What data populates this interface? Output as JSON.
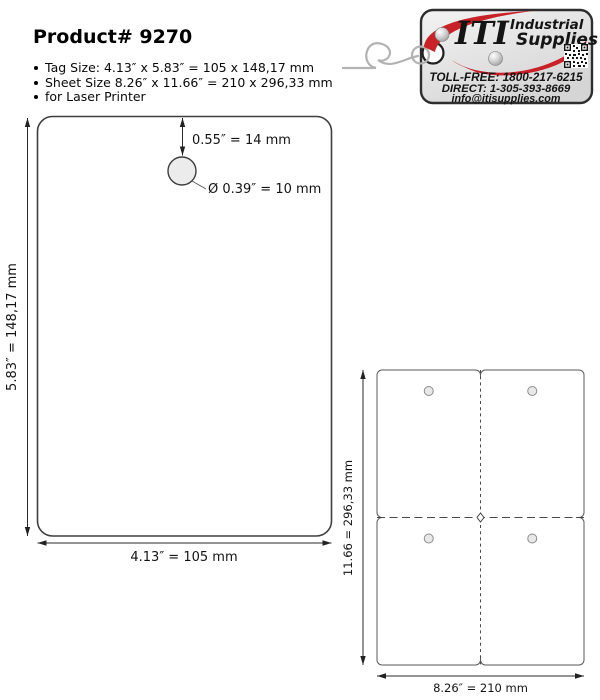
{
  "header": {
    "title": "Product# 9270"
  },
  "specs": [
    "Tag Size: 4.13″ x 5.83″ = 105 x 148,17 mm",
    "Sheet Size 8.26″ x 11.66″ = 210 x 296,33 mm",
    "for Laser Printer"
  ],
  "logo": {
    "brand": {
      "iti": "ITI",
      "industrial": "Industrial",
      "supplies": "Supplies"
    },
    "toll_free": "TOLL-FREE: 1800-217-6215",
    "direct": "DIRECT: 1-305-393-8669",
    "email": "info@itisupplies.com",
    "colors": {
      "blue": "#322b91",
      "red": "#c92128",
      "gray": "#9b9b9b",
      "tag_fill": "#e3e3e3"
    }
  },
  "tag_diagram": {
    "hole_offset": "0.55″ = 14 mm",
    "hole_diameter": "Ø 0.39″ = 10 mm",
    "height": "5.83″ = 148,17 mm",
    "width": "4.13″ = 105 mm"
  },
  "sheet_diagram": {
    "height": "11.66 = 296,33 mm",
    "width": "8.26″ = 210 mm"
  }
}
